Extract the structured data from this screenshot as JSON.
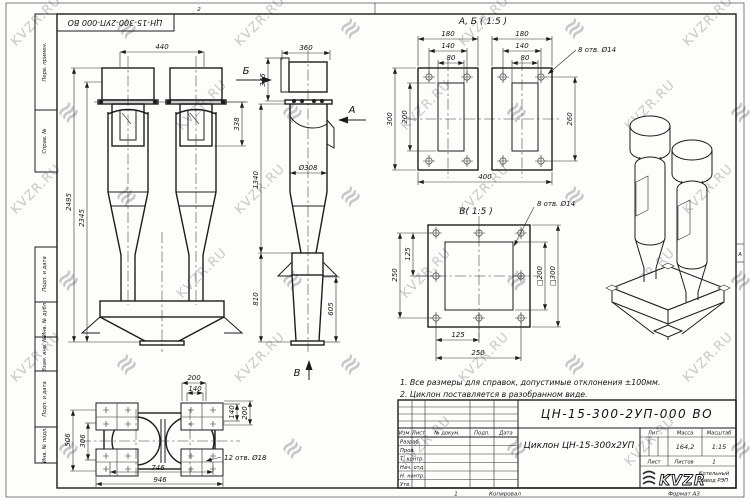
{
  "sheet": {
    "watermark_text": "KVZR.RU",
    "watermark_logo_glyph": "≋",
    "watermark_color": "#c8c8c8",
    "top_doc_number": "ЦН-15-300-2УП-000 ВО",
    "fold_mark_top": "2",
    "fold_mark_bottom": "1",
    "zone_letter": "А"
  },
  "margin_stamps": {
    "top": [
      "Перв. примен.",
      "Справ. №"
    ],
    "bottom": [
      "Подп. и дата",
      "Инв. № дубл.",
      "Взам. инв. №",
      "Подп. и дата",
      "Инв. № подл."
    ]
  },
  "notes": {
    "line1": "1. Все размеры для справок, допустимые отклонения ±100мм.",
    "line2": "2. Циклон поставляется в разобранном виде."
  },
  "front_view": {
    "dim_440": "440",
    "dim_338": "338",
    "dim_2495": "2495",
    "dim_2345": "2345"
  },
  "side_view": {
    "dim_360": "360",
    "dim_345": "345",
    "dim_1340": "1340",
    "dim_d308": "Ø308",
    "dim_810": "810",
    "dim_605": "605",
    "label_a": "А",
    "label_b": "Б",
    "label_v": "В"
  },
  "ab_view": {
    "title": "А, Б ( 1:5 )",
    "dim_180_l": "180",
    "dim_180_r": "180",
    "dim_140_l": "140",
    "dim_140_r": "140",
    "dim_80_l": "80",
    "dim_80_r": "80",
    "dim_300": "300",
    "dim_200": "200",
    "dim_260": "260",
    "dim_400": "400",
    "holes_note": "8 отв. Ø14"
  },
  "v_view": {
    "title": "В( 1:5 )",
    "dim_250_l": "250",
    "dim_125_l": "125",
    "dim_125_b": "125",
    "dim_250_b": "250",
    "dim_sq200": "□200",
    "dim_sq300": "□300",
    "holes_note": "8 отв. Ø14"
  },
  "plan_view": {
    "dim_200_t": "200",
    "dim_140_t": "140",
    "dim_140_r": "140",
    "dim_200_r": "200",
    "dim_306": "306",
    "dim_506": "506",
    "dim_746": "746",
    "dim_946": "946",
    "holes_note": "12 отв. Ø18"
  },
  "title_block": {
    "doc_number": "ЦН-15-300-2УП-000 ВО",
    "product_name": "Циклон ЦН-15-300х2УП",
    "header_cols": {
      "izm": "Изм.",
      "list": "Лист",
      "doc": "№ докум.",
      "podp": "Подп.",
      "data": "Дата"
    },
    "rows": {
      "r1": "Разраб.",
      "r2": "Пров.",
      "r3": "Т. контр.",
      "r4": "Нач. отд.",
      "r5": "Н. контр.",
      "r6": "Утв."
    },
    "lit_label": "Лит.",
    "mass_label": "Масса",
    "scale_label": "Масштаб",
    "mass_value": "164,2",
    "scale_value": "1:15",
    "sheet_label": "Лист",
    "sheets_label": "Листов",
    "sheets_value": "1",
    "copied_label": "Копировал",
    "format_label": "Формат А3",
    "logo_text": "KVZR",
    "logo_sub1": "Котельный",
    "logo_sub2": "завод РЭП"
  }
}
